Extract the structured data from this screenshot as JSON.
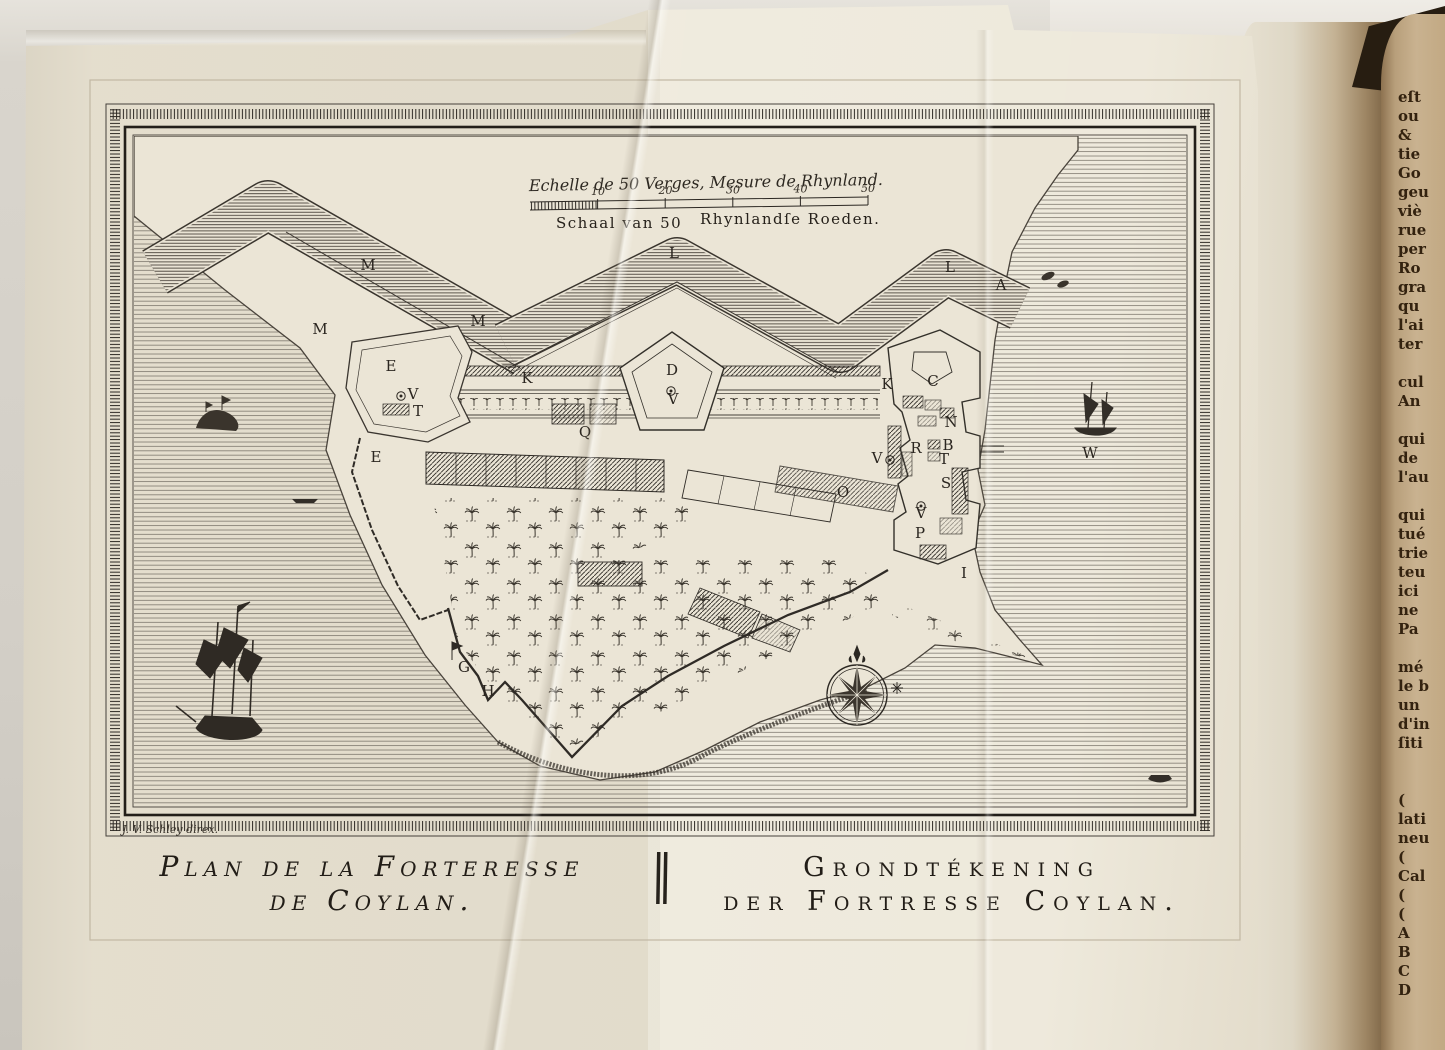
{
  "plate": {
    "scale": {
      "french": "Echelle de 50 Verges, Mesure de Rhynland.",
      "dutch_left": "Schaal van 50",
      "dutch_right": "Rhynlandſe Roeden.",
      "ticks": [
        "10",
        "20",
        "30",
        "40",
        "50"
      ]
    },
    "caption_french_1": "Plan de la Forteresse",
    "caption_french_2": "de Coylan.",
    "caption_dutch_1": "Grondtékening",
    "caption_dutch_2": "der Fortresse Coylan.",
    "signature": "J. V. Schley direx.",
    "labels": [
      {
        "t": "M",
        "x": 368,
        "y": 270
      },
      {
        "t": "M",
        "x": 320,
        "y": 334
      },
      {
        "t": "M",
        "x": 478,
        "y": 326
      },
      {
        "t": "L",
        "x": 674,
        "y": 258
      },
      {
        "t": "L",
        "x": 950,
        "y": 272
      },
      {
        "t": "A",
        "x": 1001,
        "y": 290
      },
      {
        "t": "E",
        "x": 391,
        "y": 371
      },
      {
        "t": "V",
        "x": 413,
        "y": 399
      },
      {
        "t": "T",
        "x": 418,
        "y": 416
      },
      {
        "t": "K",
        "x": 527,
        "y": 383
      },
      {
        "t": "K",
        "x": 887,
        "y": 389
      },
      {
        "t": "D",
        "x": 672,
        "y": 375
      },
      {
        "t": "V",
        "x": 673,
        "y": 404
      },
      {
        "t": "Q",
        "x": 585,
        "y": 437
      },
      {
        "t": "E",
        "x": 376,
        "y": 462
      },
      {
        "t": "C",
        "x": 933,
        "y": 386
      },
      {
        "t": "N",
        "x": 951,
        "y": 427
      },
      {
        "t": "R",
        "x": 916,
        "y": 453
      },
      {
        "t": "B",
        "x": 948,
        "y": 450
      },
      {
        "t": "T",
        "x": 944,
        "y": 464
      },
      {
        "t": "S",
        "x": 946,
        "y": 488
      },
      {
        "t": "V",
        "x": 877,
        "y": 463
      },
      {
        "t": "O",
        "x": 843,
        "y": 497
      },
      {
        "t": "V",
        "x": 921,
        "y": 518
      },
      {
        "t": "P",
        "x": 920,
        "y": 538
      },
      {
        "t": "I",
        "x": 964,
        "y": 578
      },
      {
        "t": "W",
        "x": 1090,
        "y": 458
      },
      {
        "t": "G",
        "x": 464,
        "y": 672
      },
      {
        "t": "H",
        "x": 488,
        "y": 696
      }
    ]
  },
  "adjacent_page": {
    "lines": [
      "eſt",
      "ou",
      "&",
      "tie",
      "Go",
      "geu",
      "viè",
      "rue",
      "per",
      "Ro",
      "gra",
      "qu",
      "l'ai",
      "ter",
      "",
      "cul",
      "An",
      "",
      "qui",
      "de",
      "l'au",
      "",
      "qui",
      "tué",
      "trie",
      "teu",
      "ici",
      "ne",
      "Pa",
      "",
      "mé",
      "le b",
      "un",
      "d'in",
      "ſiti",
      "",
      "",
      "(",
      "lati",
      "neu",
      "(",
      "Cal",
      "(",
      "(",
      "A",
      "B",
      "C",
      "D"
    ]
  }
}
